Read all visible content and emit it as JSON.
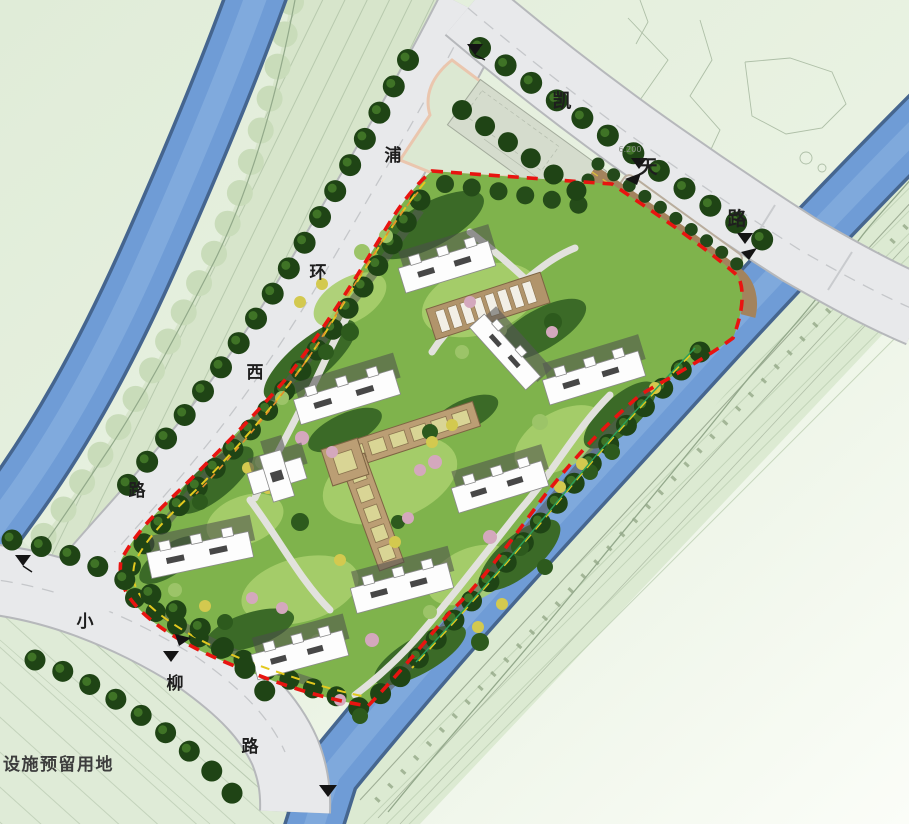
{
  "plan": {
    "roads": {
      "kaitian": {
        "name": "凯天路",
        "chars": [
          "凯",
          "天",
          "路"
        ]
      },
      "puhuanxi": {
        "name": "浦环西路",
        "chars": [
          "浦",
          "环",
          "西",
          "路"
        ]
      },
      "xiaoliu": {
        "name": "小柳路",
        "chars": [
          "小",
          "柳",
          "路"
        ]
      }
    },
    "labels": {
      "reserved_parcel": "设施预留用地",
      "elevation_kaitian": "6.200"
    },
    "colors": {
      "background": "#e3eedd",
      "river": "#6f9cd6",
      "road": "#e8e9eb",
      "site_green": "#7fb34c",
      "boundary_red": "#e81410",
      "boundary_yellow": "#e3c81e",
      "pergola_tan": "#b59a72",
      "building": "#fdfdfd"
    }
  }
}
